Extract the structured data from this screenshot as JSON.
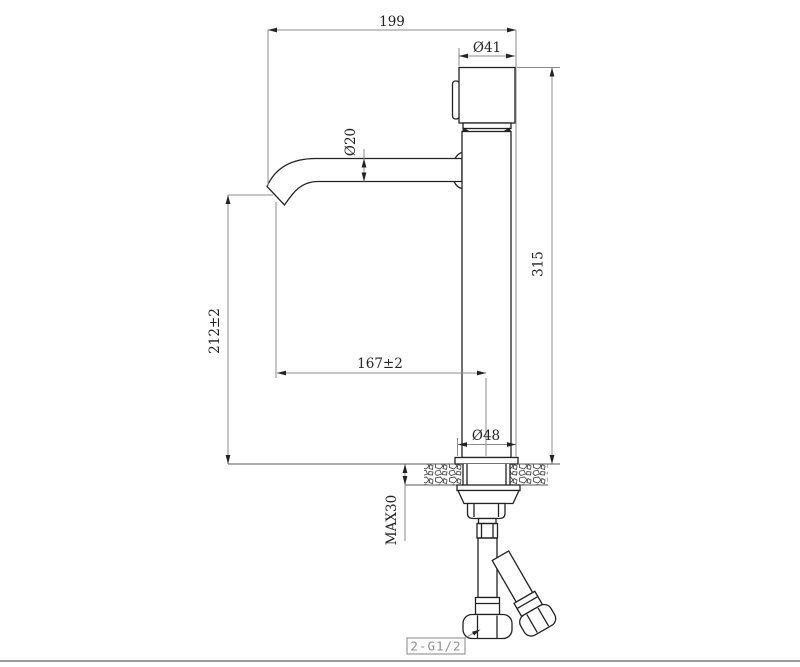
{
  "page": {
    "background": "#ffffff",
    "bottom_edge_line_color": "#9c9c9c"
  },
  "drawing": {
    "colors": {
      "object_line": "#232323",
      "dimension_line": "#8c8c8c",
      "dimension_text": "#232323",
      "callout_gray": "#8f8f8f"
    },
    "dimensions": {
      "total_width": "199",
      "handle_diameter": "Ø41",
      "spout_tube_diameter": "Ø20",
      "total_height": "315",
      "spout_outlet_height": "212±2",
      "spout_reach": "167±2",
      "base_diameter": "Ø48",
      "max_mounting_thickness": "MAX30",
      "inlet_connection": "2-G1/2"
    }
  }
}
